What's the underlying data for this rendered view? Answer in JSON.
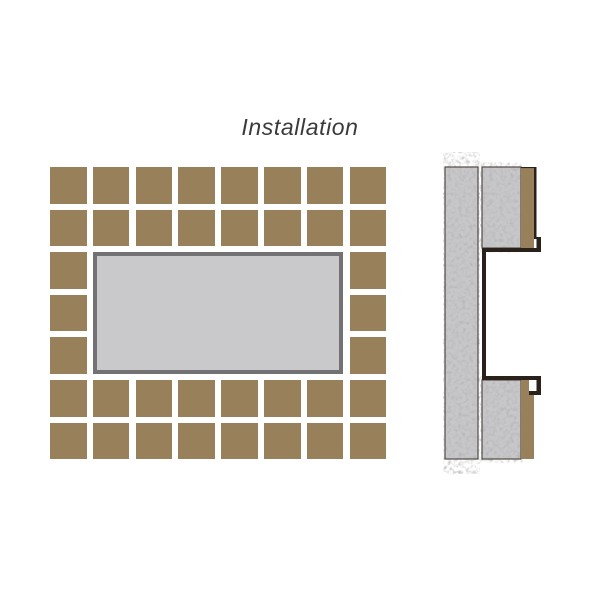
{
  "title": "Installation",
  "colors": {
    "background": "#ffffff",
    "tile_brown": "#98805a",
    "frame_gray": "#727275",
    "frame_inner_gray": "#c9c9cb",
    "concrete_base": "#c7c7c9",
    "outline_dark": "#2b211b",
    "strip_border": "#514c45",
    "title_color": "#3a3a3a"
  },
  "front_view": {
    "grid": {
      "columns": 8,
      "rows": 7,
      "tile_size": 36.6,
      "pitch_x": 42.8,
      "pitch_y": 42.6,
      "niche_col_start": 1,
      "niche_col_end": 6,
      "niche_row_start": 2,
      "niche_row_end": 4
    }
  },
  "section_view": {
    "width": 140,
    "height": 330,
    "shapes": [
      {
        "name": "substrate-left",
        "kind": "textured",
        "x": 15,
        "y": 17,
        "w": 33,
        "h": 292
      },
      {
        "name": "substrate-upper-right",
        "kind": "textured",
        "x": 52,
        "y": 17,
        "w": 39,
        "h": 81
      },
      {
        "name": "substrate-lower-right",
        "kind": "textured",
        "x": 52,
        "y": 230,
        "w": 39,
        "h": 79
      },
      {
        "name": "tile-upper",
        "kind": "tile",
        "x": 91,
        "y": 17,
        "w": 13,
        "h": 81
      },
      {
        "name": "tile-lower",
        "kind": "tile",
        "x": 91,
        "y": 230,
        "w": 13,
        "h": 79
      },
      {
        "name": "tile-upper-top-edge",
        "kind": "dark",
        "x": 91,
        "y": 17,
        "w": 15.5,
        "h": 1.1
      },
      {
        "name": "niche-front-lip-upper",
        "kind": "dark",
        "x": 104,
        "y": 17,
        "w": 2.5,
        "h": 72
      },
      {
        "name": "niche-hook-upper",
        "kind": "dark",
        "x": 106.5,
        "y": 87,
        "w": 4.5,
        "h": 15
      },
      {
        "name": "niche-top-wall",
        "kind": "dark",
        "x": 52,
        "y": 98,
        "w": 59,
        "h": 4
      },
      {
        "name": "niche-back-wall",
        "kind": "dark",
        "x": 52,
        "y": 98,
        "w": 4,
        "h": 132
      },
      {
        "name": "niche-bottom-wall",
        "kind": "dark",
        "x": 52,
        "y": 226,
        "w": 59,
        "h": 4
      },
      {
        "name": "niche-hook-lower",
        "kind": "dark",
        "x": 106.5,
        "y": 226,
        "w": 4.5,
        "h": 19
      },
      {
        "name": "niche-hook-lower-return",
        "kind": "dark",
        "x": 99,
        "y": 241,
        "w": 12,
        "h": 4
      },
      {
        "name": "niche-hook-lower-notch",
        "kind": "bg",
        "x": 99,
        "y": 230,
        "w": 7.5,
        "h": 11
      }
    ]
  }
}
